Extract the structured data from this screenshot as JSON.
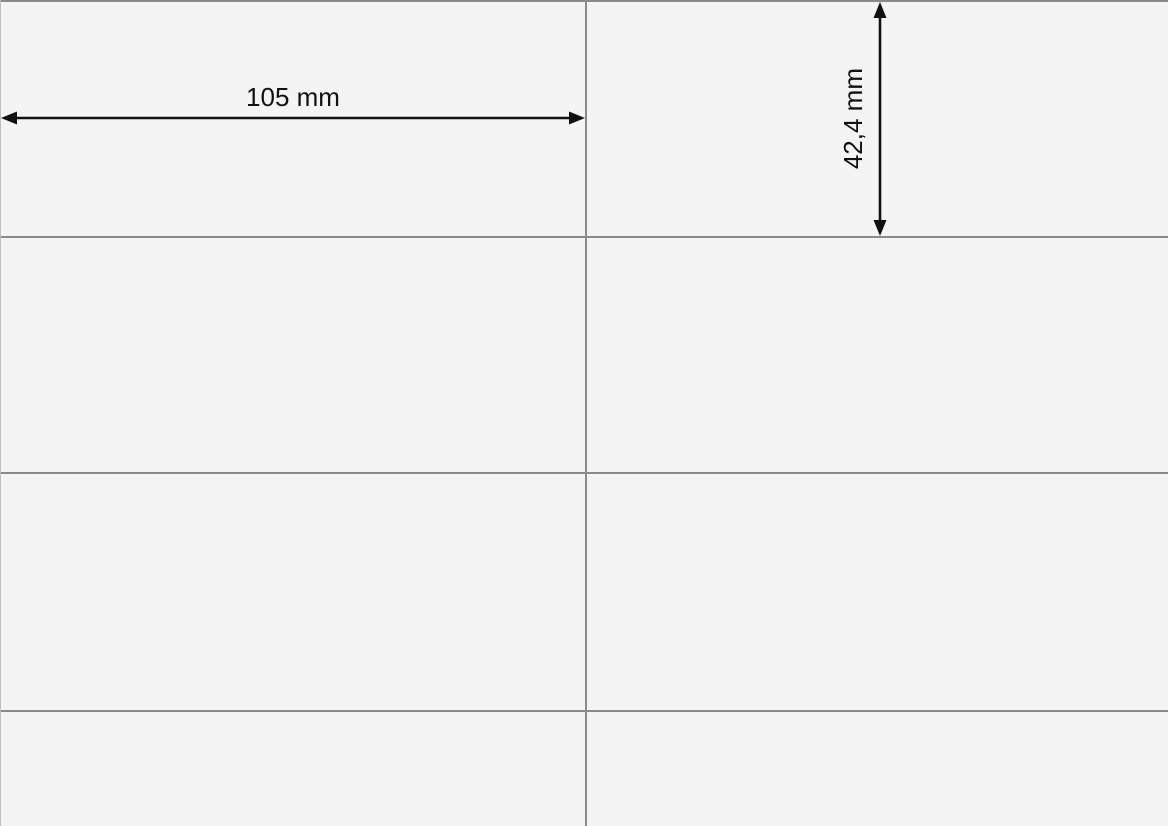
{
  "colors": {
    "background": "#f4f4f4",
    "grid-line": "#8a8a8a",
    "grid-line-faint": "#bdbdbd",
    "arrow": "#111111",
    "text": "#111111"
  },
  "sheet": {
    "columns": 2,
    "visible_rows": 4
  },
  "dimensions": {
    "width": {
      "label": "105 mm",
      "value_mm": 105,
      "orientation": "horizontal"
    },
    "height": {
      "label": "42,4 mm",
      "value_mm": 42.4,
      "orientation": "vertical"
    }
  }
}
